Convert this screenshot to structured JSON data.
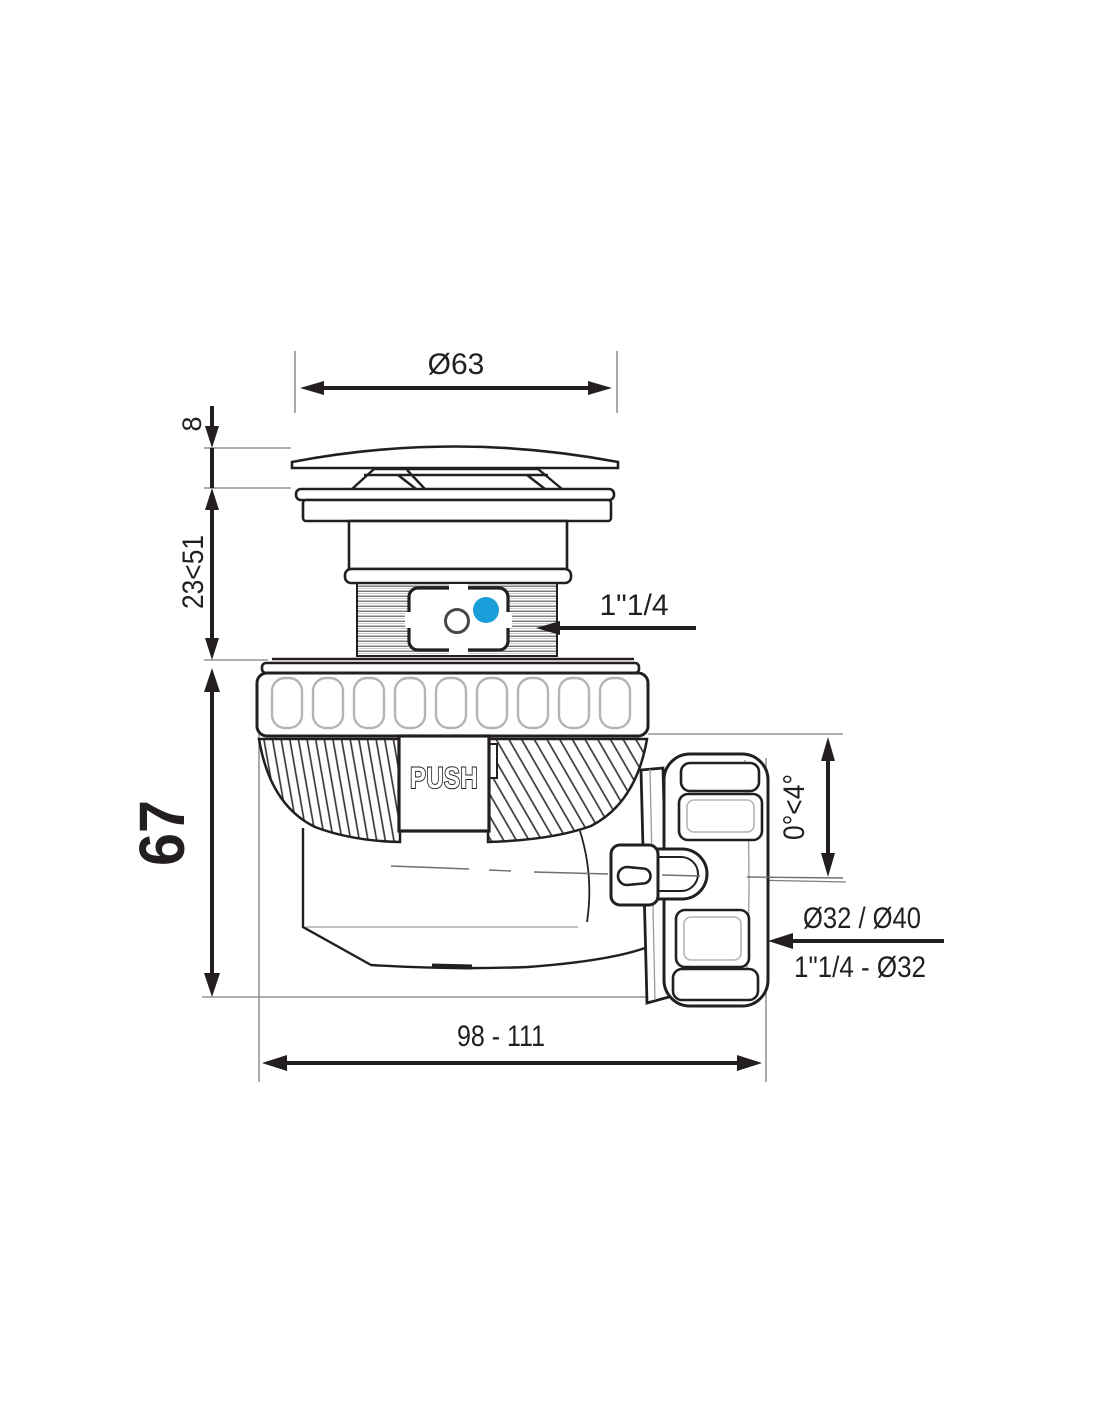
{
  "drawing": {
    "background": "#ffffff",
    "line_color": "#231f20",
    "accent_blue": "#1b9fdb",
    "dims": {
      "cap_diameter": "Ø63",
      "cap_height": "8",
      "adjust_range": "23<51",
      "trap_height": "67",
      "inlet_thread": "1\"1/4",
      "tilt_range": "0°<4°",
      "outlet_line1": "Ø32 / Ø40",
      "outlet_line2": "1\"1/4 - Ø32",
      "overall_length": "98 - 111"
    },
    "labels": {
      "push_button": "PUSH"
    }
  }
}
